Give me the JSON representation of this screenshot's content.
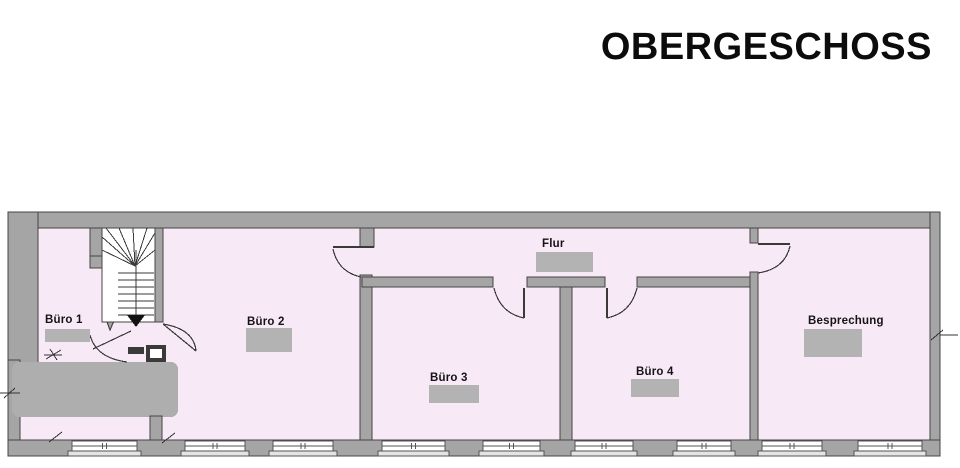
{
  "title": "OBERGESCHOSS",
  "plan_name": "floor-plan-obergeschoss",
  "colors": {
    "wall": "#a4a5a4",
    "wall_outline": "#454545",
    "floor": "#f8e9f6",
    "value_box": "#b3b3b3",
    "redacted_area": "#aeaeae",
    "text": "#141414",
    "window_fill": "#ffffff",
    "window_sill": "#e4e4e4"
  },
  "rooms": [
    {
      "id": "buero1",
      "label": "Büro 1",
      "label_x": 45,
      "label_y": 314,
      "box": {
        "x": 45,
        "y": 329,
        "w": 45,
        "h": 13
      }
    },
    {
      "id": "buero2",
      "label": "Büro 2",
      "label_x": 247,
      "label_y": 316,
      "box": {
        "x": 246,
        "y": 328,
        "w": 46,
        "h": 24
      }
    },
    {
      "id": "buero3",
      "label": "Büro 3",
      "label_x": 430,
      "label_y": 372,
      "box": {
        "x": 429,
        "y": 385,
        "w": 50,
        "h": 18
      }
    },
    {
      "id": "buero4",
      "label": "Büro 4",
      "label_x": 636,
      "label_y": 366,
      "box": {
        "x": 631,
        "y": 379,
        "w": 48,
        "h": 18
      }
    },
    {
      "id": "flur",
      "label": "Flur",
      "label_x": 542,
      "label_y": 238,
      "box": {
        "x": 536,
        "y": 252,
        "w": 57,
        "h": 20
      }
    },
    {
      "id": "besprechung",
      "label": "Besprechung",
      "label_x": 808,
      "label_y": 315,
      "box": {
        "x": 804,
        "y": 329,
        "w": 58,
        "h": 28
      }
    }
  ],
  "windows": [
    {
      "x1": 72,
      "x2": 137
    },
    {
      "x1": 185,
      "x2": 245
    },
    {
      "x1": 273,
      "x2": 333
    },
    {
      "x1": 382,
      "x2": 445
    },
    {
      "x1": 483,
      "x2": 540
    },
    {
      "x1": 575,
      "x2": 633
    },
    {
      "x1": 677,
      "x2": 731
    },
    {
      "x1": 762,
      "x2": 822
    },
    {
      "x1": 858,
      "x2": 922
    }
  ]
}
